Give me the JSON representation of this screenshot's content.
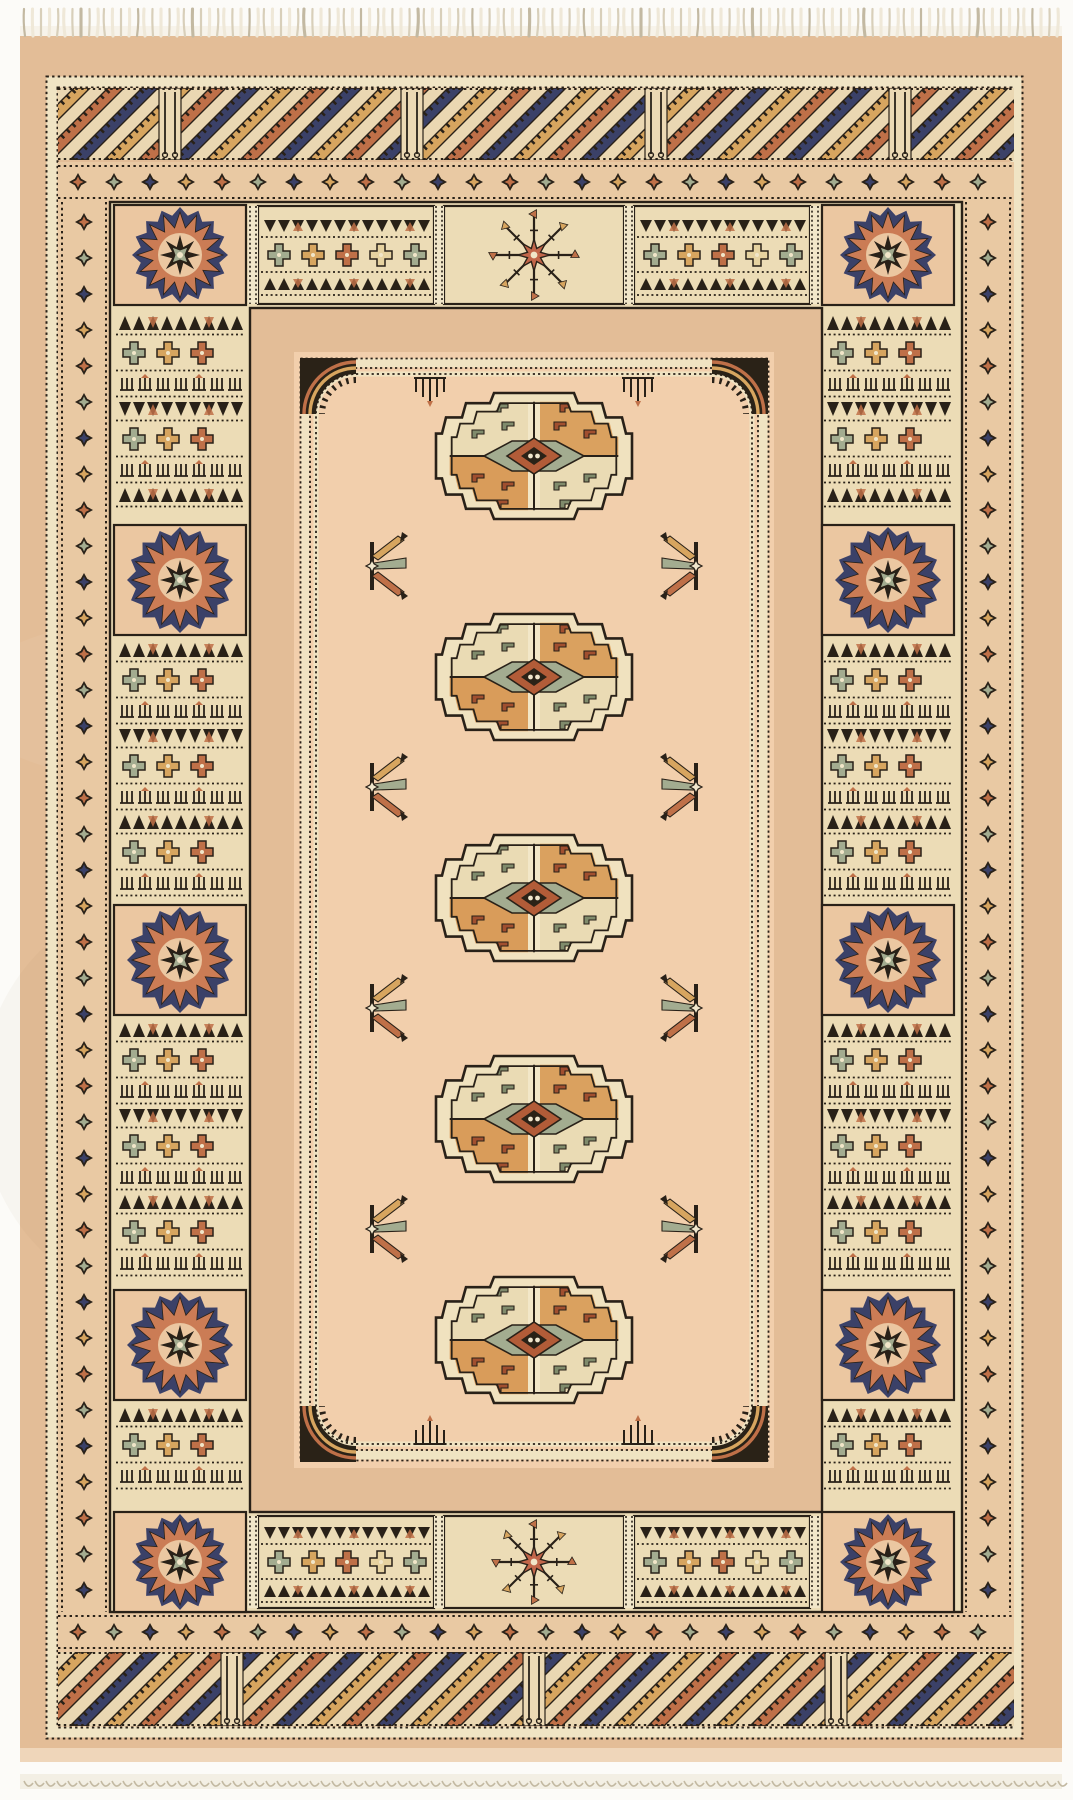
{
  "image": {
    "type": "photograph",
    "subject": "Hand-knotted beige Bokhara (Tekke-gul) oriental rug seen from above",
    "alt": "Beige-peach Bokhara rug with a column of five octagonal guls in the center field, geometric star-panel borders, diagonal striped end borders, and ivory fringe at top and bottom",
    "width": 1073,
    "height": 1800
  },
  "palette": {
    "bg": "#fcfbf8",
    "fringe": "#efe8d8",
    "fringeShadow": "#d8cfba",
    "fringeDark": "#c3b9a2",
    "rug": "#e3bd97",
    "selvage": "#efd6ba",
    "field": "#f2cfac",
    "cream": "#ecdcb6",
    "creamLight": "#f1e6c9",
    "outline": "#292118",
    "navy": "#3b4168",
    "rust": "#bf7048",
    "salmon": "#cb7c55",
    "gold": "#d7a55f",
    "sage": "#a3ac90",
    "brick": "#b25c38",
    "dark": "#2a2217",
    "paleGold": "#e6d2a0"
  },
  "scene": {
    "rug": {
      "x": 20,
      "y": 32,
      "w": 1042,
      "h": 1724
    },
    "fringe": {
      "top_strands": 130,
      "bottom_loops": 95,
      "top_band_y": 26,
      "bottom_band_y": 1774
    },
    "outer_guard": {
      "x": 46,
      "y": 76,
      "w": 976,
      "h": 1662
    },
    "diag_bands": [
      {
        "x": 58,
        "y": 88,
        "w": 956,
        "h": 72,
        "posts": [
          170,
          412,
          656,
          900
        ]
      },
      {
        "x": 58,
        "y": 1652,
        "w": 956,
        "h": 74,
        "posts": [
          232,
          534,
          836
        ]
      }
    ],
    "diamond_guards": [
      {
        "o": "h",
        "x": 58,
        "y": 162,
        "len": 956,
        "h": 40
      },
      {
        "o": "h",
        "x": 58,
        "y": 1612,
        "len": 956,
        "h": 40
      },
      {
        "o": "v",
        "x": 58,
        "y": 202,
        "len": 1410,
        "h": 52
      },
      {
        "o": "v",
        "x": 962,
        "y": 202,
        "len": 1410,
        "h": 52
      },
      {
        "o": "h",
        "x": 294,
        "y": 308,
        "len": 480,
        "h": 44
      },
      {
        "o": "h",
        "x": 294,
        "y": 1468,
        "len": 480,
        "h": 44
      },
      {
        "o": "v",
        "x": 250,
        "y": 308,
        "len": 1204,
        "h": 44
      },
      {
        "o": "v",
        "x": 774,
        "y": 308,
        "len": 1204,
        "h": 44
      }
    ],
    "main_border": {
      "ring_outer": [
        110,
        202,
        852,
        1410
      ],
      "ring_inner": [
        250,
        308,
        572,
        1204
      ],
      "corner_sunbursts": [
        [
          180,
          255
        ],
        [
          888,
          255
        ],
        [
          180,
          1562
        ],
        [
          888,
          1562
        ]
      ],
      "side_columns_x": [
        180,
        888
      ],
      "side_sunbursts_y": [
        580,
        960,
        1345
      ],
      "side_sections_y": [
        [
          311,
          522
        ],
        [
          638,
          902
        ],
        [
          1018,
          1287
        ],
        [
          1403,
          1509
        ]
      ],
      "top_row": {
        "y": 206,
        "h": 98,
        "panels": [
          {
            "type": "striped",
            "x": 258,
            "w": 176
          },
          {
            "type": "snowflake",
            "x": 444,
            "w": 180
          },
          {
            "type": "striped",
            "x": 634,
            "w": 176
          }
        ]
      },
      "bottom_row": {
        "y": 1516,
        "h": 92,
        "panels": [
          {
            "type": "striped",
            "x": 258,
            "w": 176
          },
          {
            "type": "snowflake",
            "x": 444,
            "w": 180
          },
          {
            "type": "striped",
            "x": 634,
            "w": 176
          }
        ]
      }
    },
    "field": {
      "bg": [
        294,
        352,
        480,
        1116
      ],
      "frame_outer": [
        300,
        358,
        468,
        1102
      ],
      "frame_inner": [
        316,
        374,
        436,
        1070
      ],
      "frame_corner_radius": 40,
      "center": [
        534,
        910
      ]
    },
    "guls": {
      "cx": 534,
      "cy": [
        456,
        677,
        898,
        1119,
        1340
      ],
      "rx": 98,
      "ry": 63
    },
    "chemche": {
      "left_x": 372,
      "right_x": 696,
      "rows_y": [
        566,
        787,
        1008,
        1229
      ]
    },
    "combs": {
      "xs": [
        430,
        638
      ],
      "top_y": 378,
      "bottom_y": 1444
    }
  }
}
